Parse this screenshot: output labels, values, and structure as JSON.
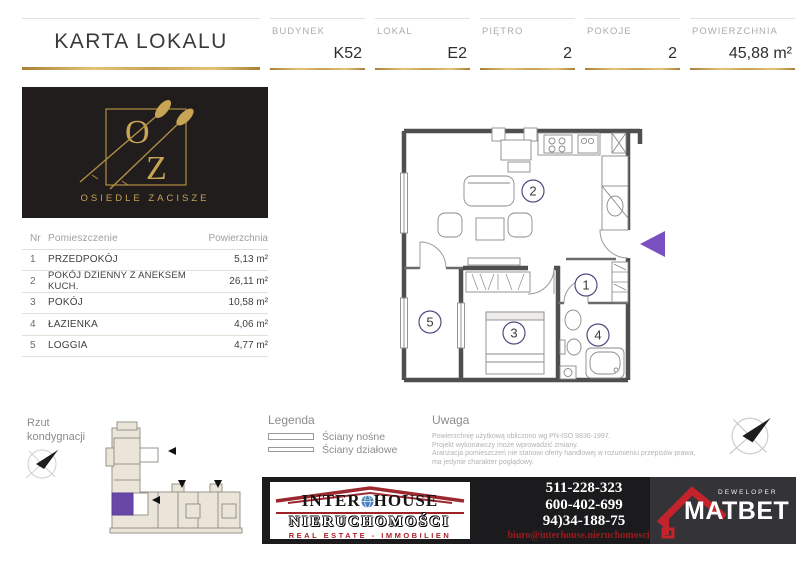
{
  "title": "KARTA LOKALU",
  "header": {
    "fields": [
      {
        "label": "BUDYNEK",
        "value": "K52"
      },
      {
        "label": "LOKAL",
        "value": "E2"
      },
      {
        "label": "PIĘTRO",
        "value": "2"
      },
      {
        "label": "POKOJE",
        "value": "2"
      },
      {
        "label": "POWIERZCHNIA",
        "value": "45,88 m²"
      }
    ]
  },
  "estate_logo": {
    "letter_o": "O",
    "letter_z": "Z",
    "name": "OSIEDLE ZACISZE"
  },
  "rooms_table": {
    "columns": {
      "nr": "Nr",
      "name": "Pomieszczenie",
      "area": "Powierzchnia"
    },
    "rows": [
      {
        "nr": "1",
        "name": "PRZEDPOKÓJ",
        "area": "5,13 m²"
      },
      {
        "nr": "2",
        "name": "POKÓJ DZIENNY Z ANEKSEM KUCH.",
        "area": "26,11 m²"
      },
      {
        "nr": "3",
        "name": "POKÓJ",
        "area": "10,58 m²"
      },
      {
        "nr": "4",
        "name": "ŁAZIENKA",
        "area": "4,06 m²"
      },
      {
        "nr": "5",
        "name": "LOGGIA",
        "area": "4,77 m²"
      }
    ]
  },
  "floor_plan": {
    "labels": {
      "hall": "1",
      "living": "2",
      "bedroom": "3",
      "bath": "4",
      "loggia": "5"
    }
  },
  "bottom": {
    "rzut_line1": "Rzut",
    "rzut_line2": "kondygnacji",
    "legend": {
      "title": "Legenda",
      "item1": "Ściany nośne",
      "item2": "Ściany działowe"
    },
    "uwaga": {
      "title": "Uwaga",
      "lines": [
        "Powierzchnię użytkową obliczono wg PN-ISO 9836-1997.",
        "Projekt wykonawczy może wprowadzić zmiany.",
        "Aranżacja pomieszczeń nie stanowi oferty handlowej w rozumieniu przepisów prawa,",
        "ma jedynie charakter poglądowy."
      ]
    },
    "agency": {
      "inter": "INTER",
      "house": "HOUSE",
      "sub": "NIERUCHOMOŚCI",
      "tagline": "REAL ESTATE - IMMOBILIEN",
      "phones": [
        "511-228-323",
        "600-402-699",
        "94)34-188-75"
      ],
      "email": "biuro@interhouse.nieruchomosci.pl"
    },
    "developer": {
      "label": "DEWELOPER",
      "name": "MATBET"
    }
  },
  "colors": {
    "gold": "#c9a24b",
    "entrance_arrow_purple": "#7a4fc0",
    "unit_highlight_purple": "#6847a8",
    "brand_red": "#a32629"
  }
}
